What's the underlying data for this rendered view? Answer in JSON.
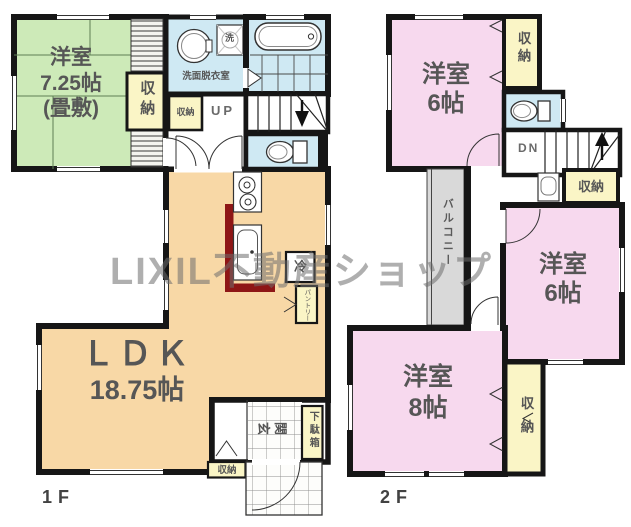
{
  "watermark": "LIXIL不動産ショップ",
  "floor1": {
    "label": "1F",
    "tatami_room": {
      "name": "洋室",
      "size": "7.25帖",
      "note": "(畳敷)"
    },
    "tatami_closet": "収納",
    "washroom": "洗面脱衣室",
    "washer": "洗",
    "hall_closet": "収納",
    "stairs": "UP",
    "ldk": {
      "name": "ＬＤＫ",
      "size": "18.75帖"
    },
    "fridge": "冷",
    "pantry": "パントリー",
    "entrance": "玄関",
    "shoe_box": "下駄箱",
    "entrance_closet": "収納"
  },
  "floor2": {
    "label": "2F",
    "bedroom_north": {
      "name": "洋室",
      "size": "6帖"
    },
    "north_closet": "収納",
    "stairs": "DN",
    "hall_closet": "収納",
    "bedroom_east": {
      "name": "洋室",
      "size": "6帖"
    },
    "balcony": "バルコニー",
    "bedroom_south": {
      "name": "洋室",
      "size": "8帖"
    },
    "south_closet": "収納"
  },
  "colors": {
    "tatami_room": "#cdeab8",
    "ldk": "#f8d8a6",
    "bedroom": "#f7d9ee",
    "wet_area": "#cfe9f3",
    "closet": "#faf5c6",
    "balcony": "#d9d9d9",
    "counter": "#8e1616",
    "wall": "#161616"
  }
}
